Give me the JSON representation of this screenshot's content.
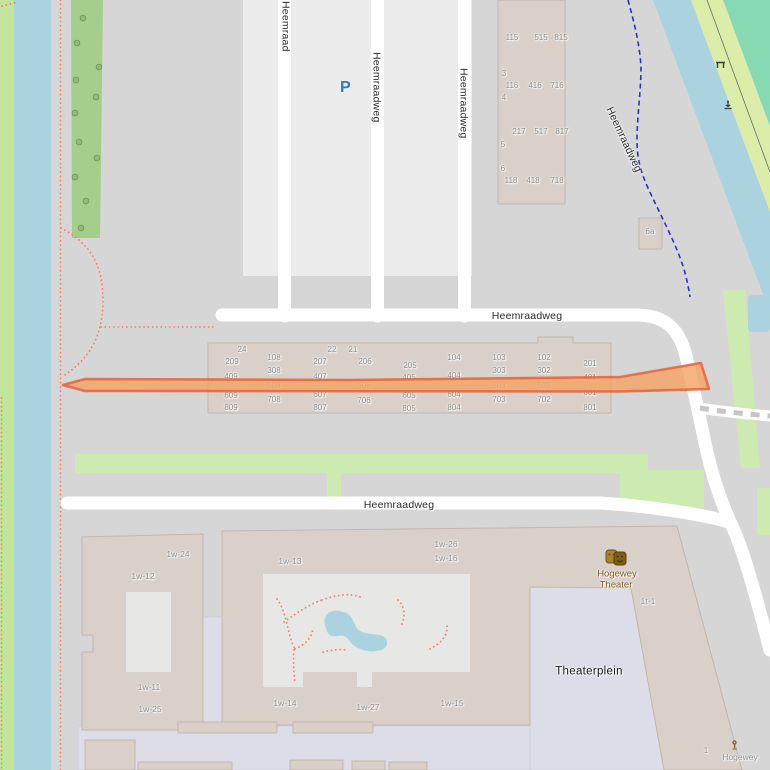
{
  "map": {
    "description": "OpenStreetMap view of Heemraadweg area with highlighted route",
    "colors": {
      "background": "#d7d6d6",
      "water": "#aad3df",
      "grass": "#cdebb0",
      "grass_yellow": "#dcedaa",
      "meadow_teal": "#87d9b3",
      "forest": "#a5cd8c",
      "building": "#d9d0c9",
      "building_outline": "#c2b6aa",
      "parking_area": "#ececec",
      "pedestrian_area": "#dddde8",
      "courtyard": "#e7e7e5",
      "road": "#ffffff",
      "route_fill": "#f4a263",
      "route_stroke": "#e8603a",
      "footpath_dotted": "#ef8368",
      "cycleway_dashed": "#2f2fc8",
      "label_dark": "#2b2b2b",
      "label_gray": "#8d8d8d",
      "poi_brown": "#7a5a1e",
      "parking_blue": "#2a7dc0"
    },
    "street_name": "Heemraadweg",
    "clipped_road_label": {
      "t": "Heemraadweg"
    },
    "road_labels": [
      {
        "t": "Heemraadweg",
        "x": 371,
        "y": 52,
        "rot": 90
      },
      {
        "t": "Heemraadweg",
        "x": 458,
        "y": 68,
        "rot": 90
      },
      {
        "t": "Heemraadweg",
        "x": 604,
        "y": 110,
        "rot": 65
      },
      {
        "t": "Heemraadweg",
        "x": 527,
        "y": 316
      },
      {
        "t": "Heemraadweg",
        "x": 399,
        "y": 505
      }
    ],
    "housenumbers": [
      {
        "t": "115",
        "x": 512,
        "y": 38
      },
      {
        "t": "515",
        "x": 541,
        "y": 38
      },
      {
        "t": "815",
        "x": 561,
        "y": 38
      },
      {
        "t": "3",
        "x": 504,
        "y": 74
      },
      {
        "t": "116",
        "x": 512,
        "y": 86
      },
      {
        "t": "416",
        "x": 535,
        "y": 86
      },
      {
        "t": "716",
        "x": 557,
        "y": 86
      },
      {
        "t": "4",
        "x": 504,
        "y": 98
      },
      {
        "t": "217",
        "x": 519,
        "y": 132
      },
      {
        "t": "517",
        "x": 541,
        "y": 132
      },
      {
        "t": "817",
        "x": 562,
        "y": 132
      },
      {
        "t": "5",
        "x": 503,
        "y": 145
      },
      {
        "t": "6",
        "x": 503,
        "y": 169
      },
      {
        "t": "118",
        "x": 511,
        "y": 181
      },
      {
        "t": "418",
        "x": 533,
        "y": 181
      },
      {
        "t": "718",
        "x": 557,
        "y": 181
      },
      {
        "t": "6a",
        "x": 650,
        "y": 232
      },
      {
        "t": "24",
        "x": 242,
        "y": 350
      },
      {
        "t": "22",
        "x": 332,
        "y": 350
      },
      {
        "t": "21",
        "x": 353,
        "y": 350
      },
      {
        "t": "209",
        "x": 232,
        "y": 362
      },
      {
        "t": "108",
        "x": 274,
        "y": 358
      },
      {
        "t": "207",
        "x": 320,
        "y": 362
      },
      {
        "t": "206",
        "x": 365,
        "y": 362
      },
      {
        "t": "205",
        "x": 410,
        "y": 366
      },
      {
        "t": "104",
        "x": 454,
        "y": 358
      },
      {
        "t": "103",
        "x": 499,
        "y": 358
      },
      {
        "t": "102",
        "x": 544,
        "y": 358
      },
      {
        "t": "201",
        "x": 590,
        "y": 364
      },
      {
        "t": "409",
        "x": 231,
        "y": 377
      },
      {
        "t": "308",
        "x": 274,
        "y": 371
      },
      {
        "t": "407",
        "x": 320,
        "y": 377
      },
      {
        "t": "405",
        "x": 409,
        "y": 378
      },
      {
        "t": "404",
        "x": 454,
        "y": 376
      },
      {
        "t": "303",
        "x": 499,
        "y": 371
      },
      {
        "t": "302",
        "x": 544,
        "y": 371
      },
      {
        "t": "401",
        "x": 590,
        "y": 378
      },
      {
        "t": "508",
        "x": 274,
        "y": 386
      },
      {
        "t": "506",
        "x": 364,
        "y": 386
      },
      {
        "t": "503",
        "x": 499,
        "y": 386
      },
      {
        "t": "502",
        "x": 544,
        "y": 386
      },
      {
        "t": "609",
        "x": 231,
        "y": 396
      },
      {
        "t": "607",
        "x": 320,
        "y": 395
      },
      {
        "t": "605",
        "x": 409,
        "y": 396
      },
      {
        "t": "604",
        "x": 454,
        "y": 395
      },
      {
        "t": "601",
        "x": 590,
        "y": 393
      },
      {
        "t": "708",
        "x": 274,
        "y": 400
      },
      {
        "t": "706",
        "x": 364,
        "y": 401
      },
      {
        "t": "703",
        "x": 499,
        "y": 400
      },
      {
        "t": "702",
        "x": 544,
        "y": 400
      },
      {
        "t": "809",
        "x": 231,
        "y": 408
      },
      {
        "t": "807",
        "x": 320,
        "y": 408
      },
      {
        "t": "805",
        "x": 409,
        "y": 409
      },
      {
        "t": "804",
        "x": 454,
        "y": 408
      },
      {
        "t": "801",
        "x": 590,
        "y": 408
      },
      {
        "t": "1",
        "x": 706,
        "y": 751
      }
    ],
    "unit_labels": [
      {
        "t": "1w-24",
        "x": 178,
        "y": 554
      },
      {
        "t": "1w-12",
        "x": 143,
        "y": 576
      },
      {
        "t": "1w-13",
        "x": 290,
        "y": 561
      },
      {
        "t": "1w-26",
        "x": 446,
        "y": 544
      },
      {
        "t": "1w-16",
        "x": 446,
        "y": 558
      },
      {
        "t": "1w-11",
        "x": 149,
        "y": 687
      },
      {
        "t": "1w-25",
        "x": 150,
        "y": 709
      },
      {
        "t": "1w-14",
        "x": 285,
        "y": 703
      },
      {
        "t": "1w-27",
        "x": 368,
        "y": 707
      },
      {
        "t": "1w-15",
        "x": 452,
        "y": 703
      },
      {
        "t": "1t-1",
        "x": 648,
        "y": 601
      },
      {
        "t": "Hogewey",
        "x": 740,
        "y": 757
      }
    ],
    "place_labels": [
      {
        "t": "Theaterplein",
        "x": 589,
        "y": 672
      }
    ],
    "poi_labels": [
      {
        "t": "Hogewey",
        "x": 617,
        "y": 574
      },
      {
        "t": "Theater",
        "x": 616,
        "y": 585
      }
    ],
    "parking_label": "P",
    "icons": [
      "parking-icon",
      "theater-masks-icon",
      "bench-icon",
      "mooring-icon",
      "artwork-icon",
      "tree-icons"
    ],
    "route": {
      "description": "highlighted route along Heemraadweg",
      "color": "#f4a263"
    }
  }
}
